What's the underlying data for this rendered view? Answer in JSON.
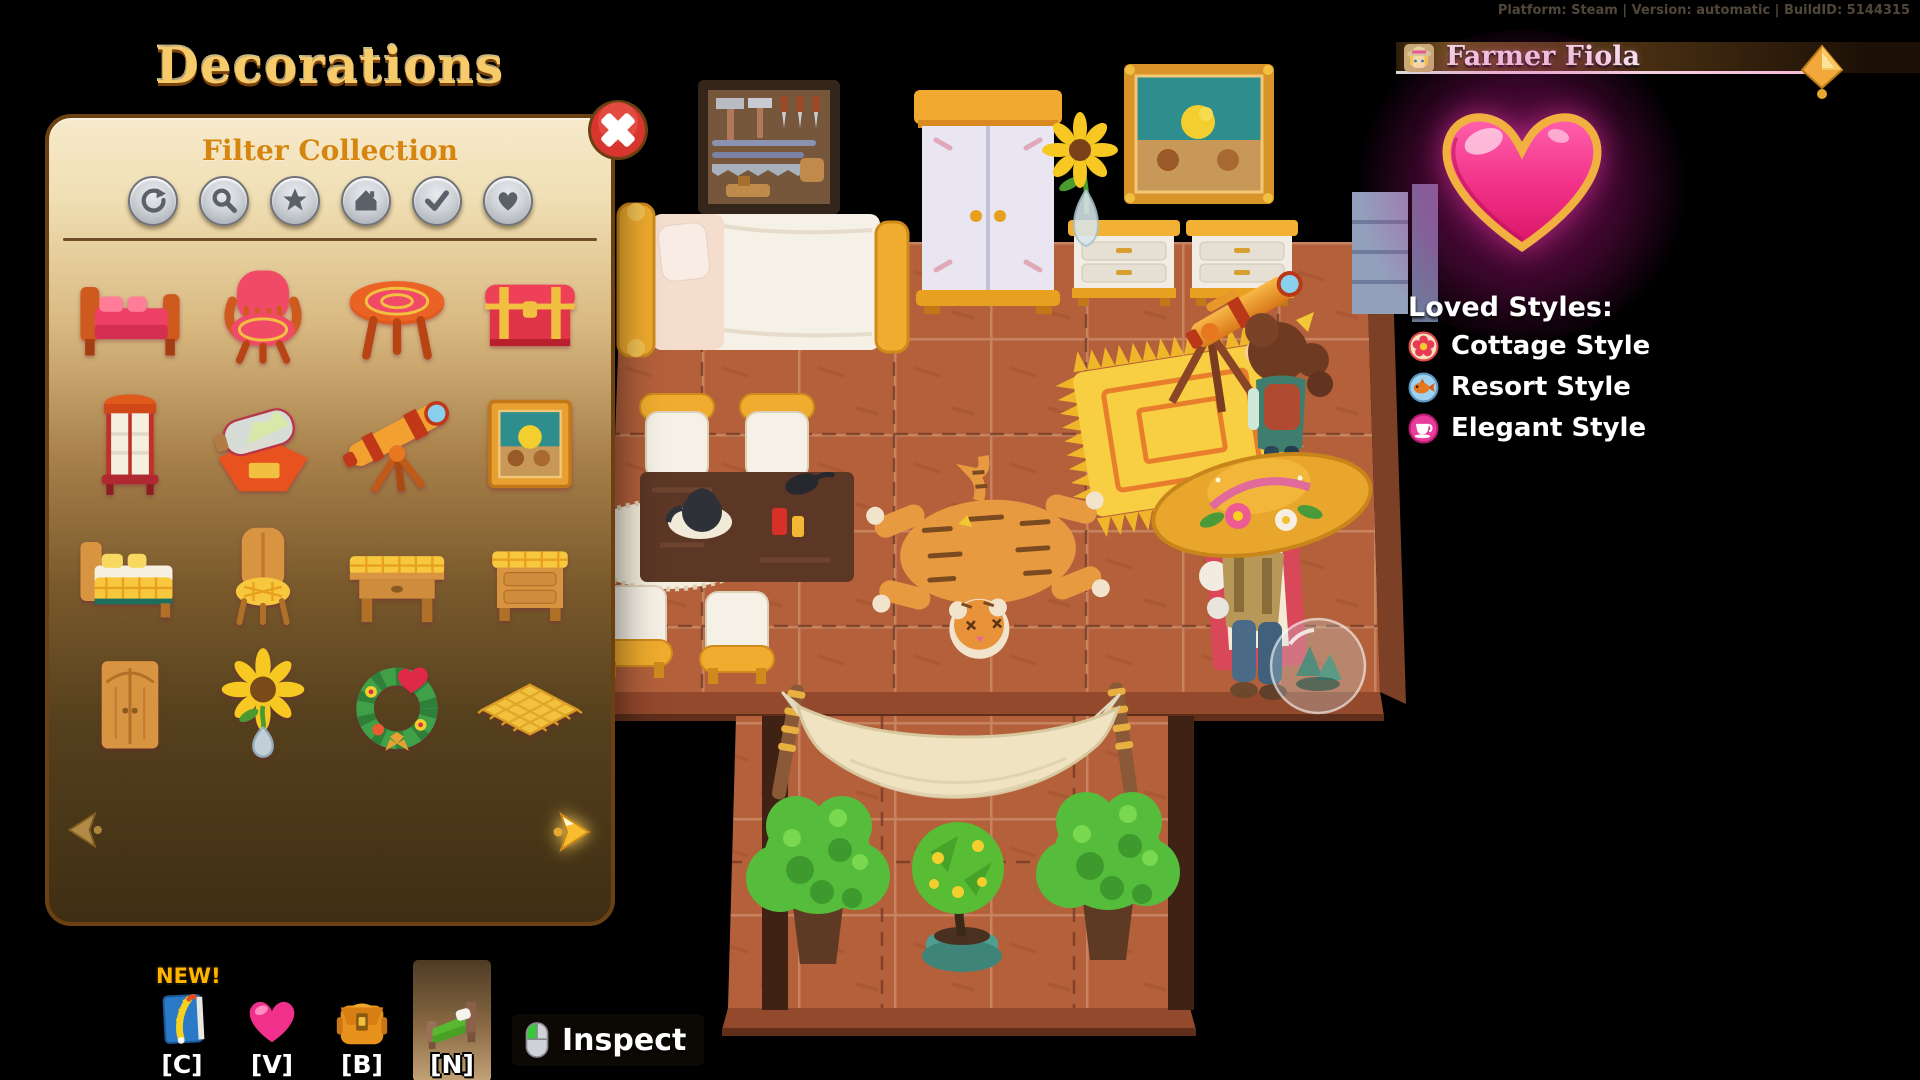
{
  "debug_info": "Platform: Steam | Version: automatic | BuildID: 5144315",
  "decorations_panel": {
    "title": "Decorations",
    "filter_header": "Filter Collection",
    "filters": [
      {
        "name": "refresh"
      },
      {
        "name": "search"
      },
      {
        "name": "star"
      },
      {
        "name": "house"
      },
      {
        "name": "check"
      },
      {
        "name": "heart"
      }
    ],
    "grid_items": [
      {
        "name": "red-bed"
      },
      {
        "name": "red-armchair"
      },
      {
        "name": "red-round-table"
      },
      {
        "name": "red-chest"
      },
      {
        "name": "red-display-case"
      },
      {
        "name": "ship-in-a-bottle"
      },
      {
        "name": "telescope"
      },
      {
        "name": "painting"
      },
      {
        "name": "yellow-bed"
      },
      {
        "name": "yellow-chair"
      },
      {
        "name": "yellow-table"
      },
      {
        "name": "yellow-nightstand"
      },
      {
        "name": "wooden-wardrobe"
      },
      {
        "name": "sunflower"
      },
      {
        "name": "holiday-wreath"
      },
      {
        "name": "straw-mat"
      }
    ],
    "pagination": {
      "total_pages": 6,
      "current_page": 1
    }
  },
  "npc_panel": {
    "title": "Farmer Fiola",
    "loved_styles_header": "Loved Styles:",
    "loved_styles": [
      {
        "icon": "flower",
        "label": "Cottage Style"
      },
      {
        "icon": "fish",
        "label": "Resort Style"
      },
      {
        "icon": "teacup",
        "label": "Elegant Style"
      }
    ],
    "colors": {
      "heart": "#f02f86",
      "glow": "#c515a0",
      "border": "#f2b040"
    }
  },
  "hotbar": {
    "new_badge": "NEW!",
    "slots": [
      {
        "key": "[C]",
        "icon": "journal",
        "selected": false
      },
      {
        "key": "[V]",
        "icon": "heart",
        "selected": false
      },
      {
        "key": "[B]",
        "icon": "backpack",
        "selected": false
      },
      {
        "key": "[N]",
        "icon": "bed",
        "selected": true
      }
    ],
    "inspect_label": "Inspect"
  },
  "scene": {
    "characters": [
      {
        "name": "Farmer Fiola"
      },
      {
        "name": "Player"
      }
    ],
    "furniture": [
      "tool-board",
      "wardrobe",
      "painting",
      "sunflower-vase",
      "nightstand",
      "nightstand",
      "telescope",
      "bookshelf",
      "double-bed",
      "dining-chair",
      "dining-chair",
      "dining-chair",
      "dining-chair",
      "dining-table",
      "oval-rug",
      "yellow-rug",
      "tiger-rug",
      "doormat",
      "bubble-ball",
      "hammock",
      "potted-bush",
      "potted-bush",
      "potted-tree"
    ]
  }
}
